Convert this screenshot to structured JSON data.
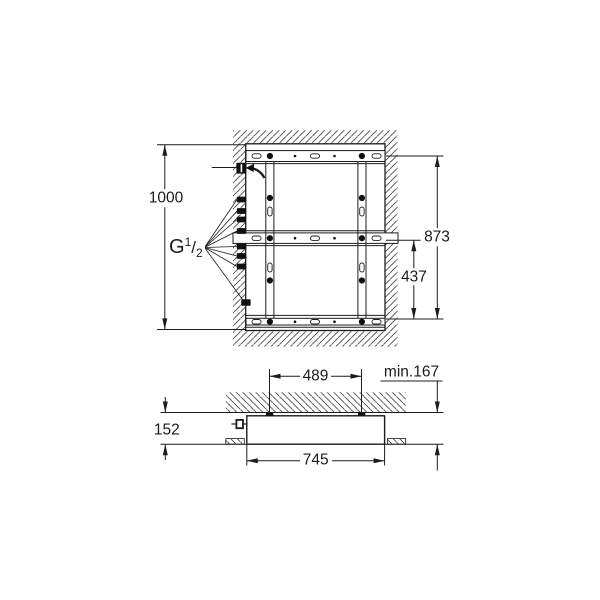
{
  "drawing": {
    "kind": "installation-dimension-drawing",
    "views": {
      "front": "recessed mounting frame in wall/ceiling opening",
      "section": "housing section below slab"
    }
  },
  "labels": {
    "front": {
      "total_height": "1000",
      "thread_g": "G",
      "thread_num": "1",
      "thread_slash": "/",
      "thread_den": "2",
      "frame_height": "873",
      "lower_section": "437"
    },
    "section": {
      "stud_spacing": "489",
      "min_depth": "min.167",
      "housing_height": "152",
      "housing_width": "745"
    }
  },
  "colors": {
    "background": "#ffffff",
    "line": "#1c1c1c",
    "hatch": "#4a4a4a",
    "fitting": "#111111"
  }
}
